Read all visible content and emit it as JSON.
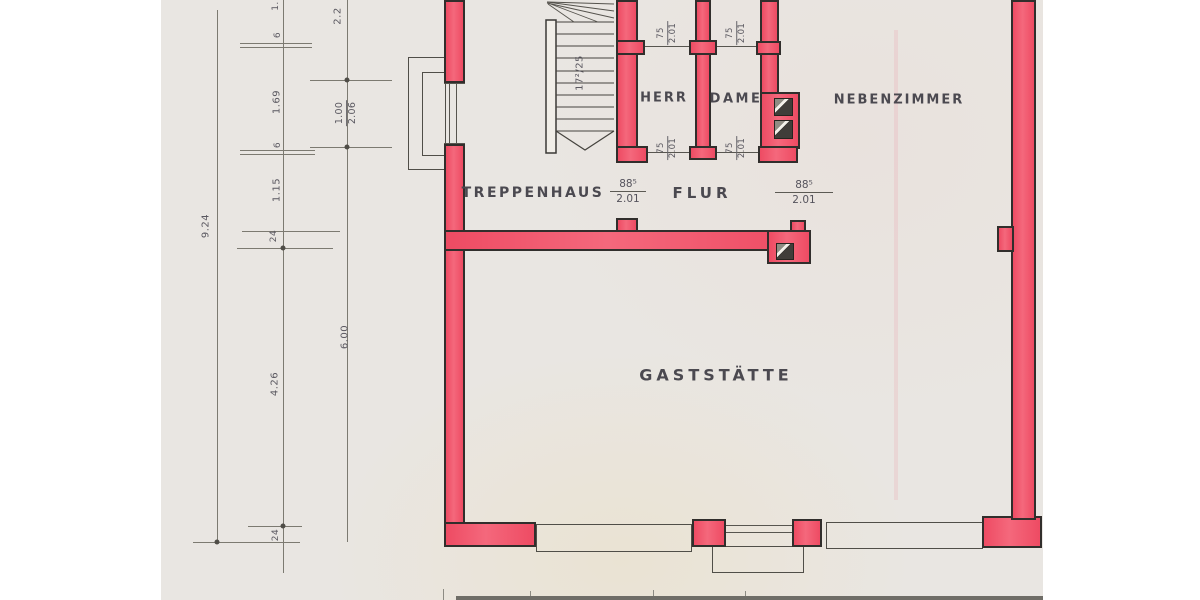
{
  "plan": {
    "title": "hand-drawn floor plan (scan)",
    "rooms": {
      "treppenhaus": "TREPPENHAUS",
      "flur": "FLUR",
      "herr": "HERR",
      "dame": "DAME",
      "nebenzimmer": "NEBENZIMMER",
      "gaststaette": "GASTSTÄTTE"
    },
    "stair_label": "17²/25",
    "door_small": [
      {
        "num": "75",
        "den": "2.01"
      },
      {
        "num": "75",
        "den": "2.01"
      },
      {
        "num": "75",
        "den": "2.01"
      },
      {
        "num": "75",
        "den": "2.01"
      }
    ],
    "door_large": [
      {
        "num": "88⁵",
        "den": "2.01"
      },
      {
        "num": "88⁵",
        "den": "2.01"
      }
    ],
    "dims": {
      "b_top_cut": "1.",
      "b_6a": "6",
      "b_169": "1.69",
      "b_6b": "6",
      "b_115": "1.15",
      "b_24a": "24",
      "b_426": "4.26",
      "b_24b": "24",
      "a_total": "9.24",
      "c_top": "2.2",
      "c_win_num": "1.00",
      "c_win_den": "2.06",
      "c_600": "6.00"
    },
    "colors": {
      "wall_fill": "#f1536a",
      "paper": "#e9e6e2",
      "ink": "#3b3936",
      "pencil": "#55535c"
    }
  }
}
